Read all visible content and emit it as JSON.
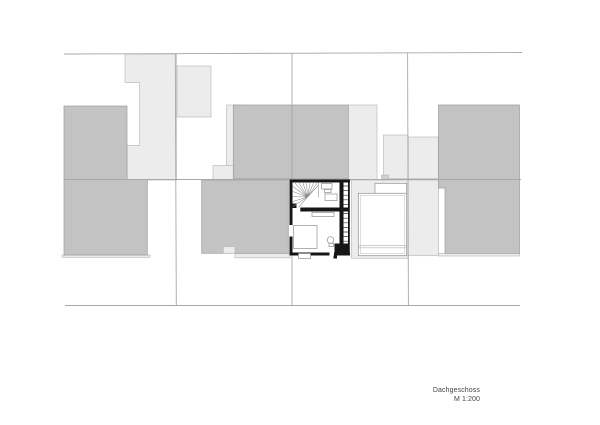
{
  "title_block": {
    "storey_label": "Dachgeschoss",
    "scale_label": "M 1:200"
  },
  "colors": {
    "background": "#ffffff",
    "neighbor_roof_dark": "#c3c3c3",
    "neighbor_building_light": "#ececec",
    "site_line": "#a8a8a8",
    "subject_wall": "#161616",
    "label_text": "#444444"
  }
}
